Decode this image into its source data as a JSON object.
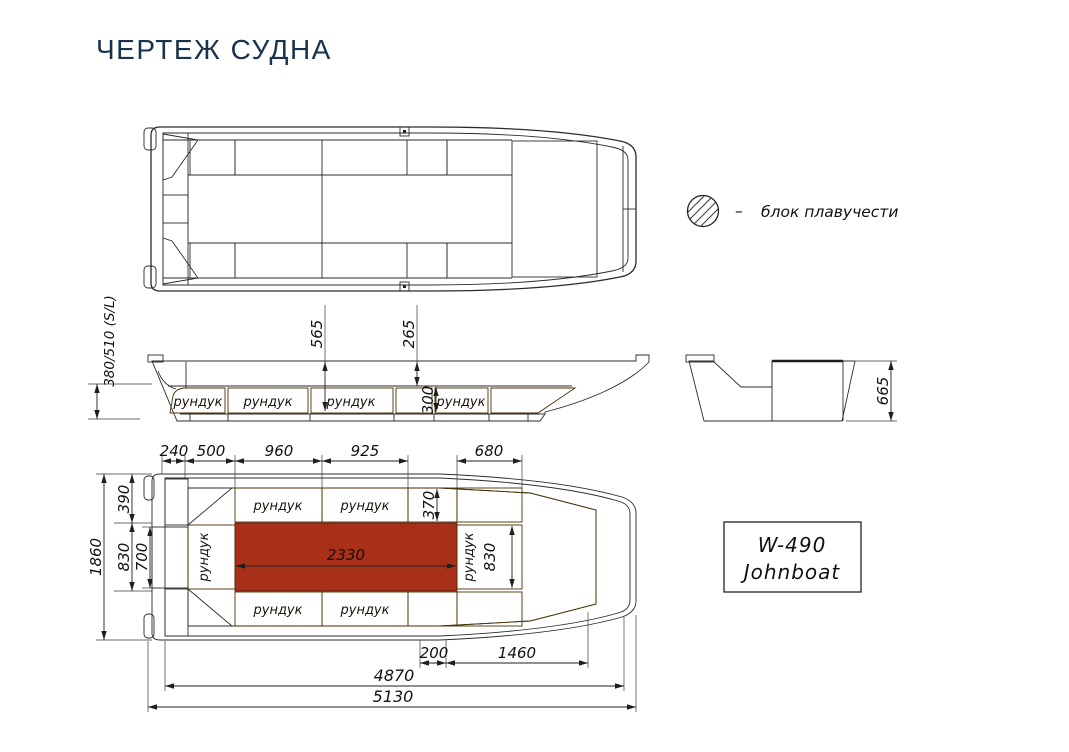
{
  "page": {
    "title": "ЧЕРТЕЖ СУДНА"
  },
  "legend": {
    "separator": "–",
    "label": "блок плавучести"
  },
  "labels": {
    "locker": "рундук"
  },
  "model_label": {
    "line1": "W-490",
    "line2": "Johnboat"
  },
  "dims": {
    "side_freeboard": "380/510 (S/L)",
    "side_565": "565",
    "side_265": "265",
    "side_300": "300",
    "transom_665": "665",
    "plan_240": "240",
    "plan_500": "500",
    "plan_960": "960",
    "plan_925": "925",
    "plan_680": "680",
    "plan_1860": "1860",
    "plan_390": "390",
    "plan_830_left": "830",
    "plan_700": "700",
    "plan_370": "370",
    "plan_2330": "2330",
    "plan_830_right": "830",
    "plan_200": "200",
    "plan_1460": "1460",
    "plan_4870": "4870",
    "plan_5130": "5130"
  },
  "colors": {
    "title": "#17334e",
    "locker_orange": "#f6a81f",
    "floor_red": "#a93018",
    "hull_gray": "#dcdcdc",
    "stern_gray": "#e3e3e3",
    "hatch_bg": "#c9c9c9",
    "line": "#2b2b2b"
  }
}
